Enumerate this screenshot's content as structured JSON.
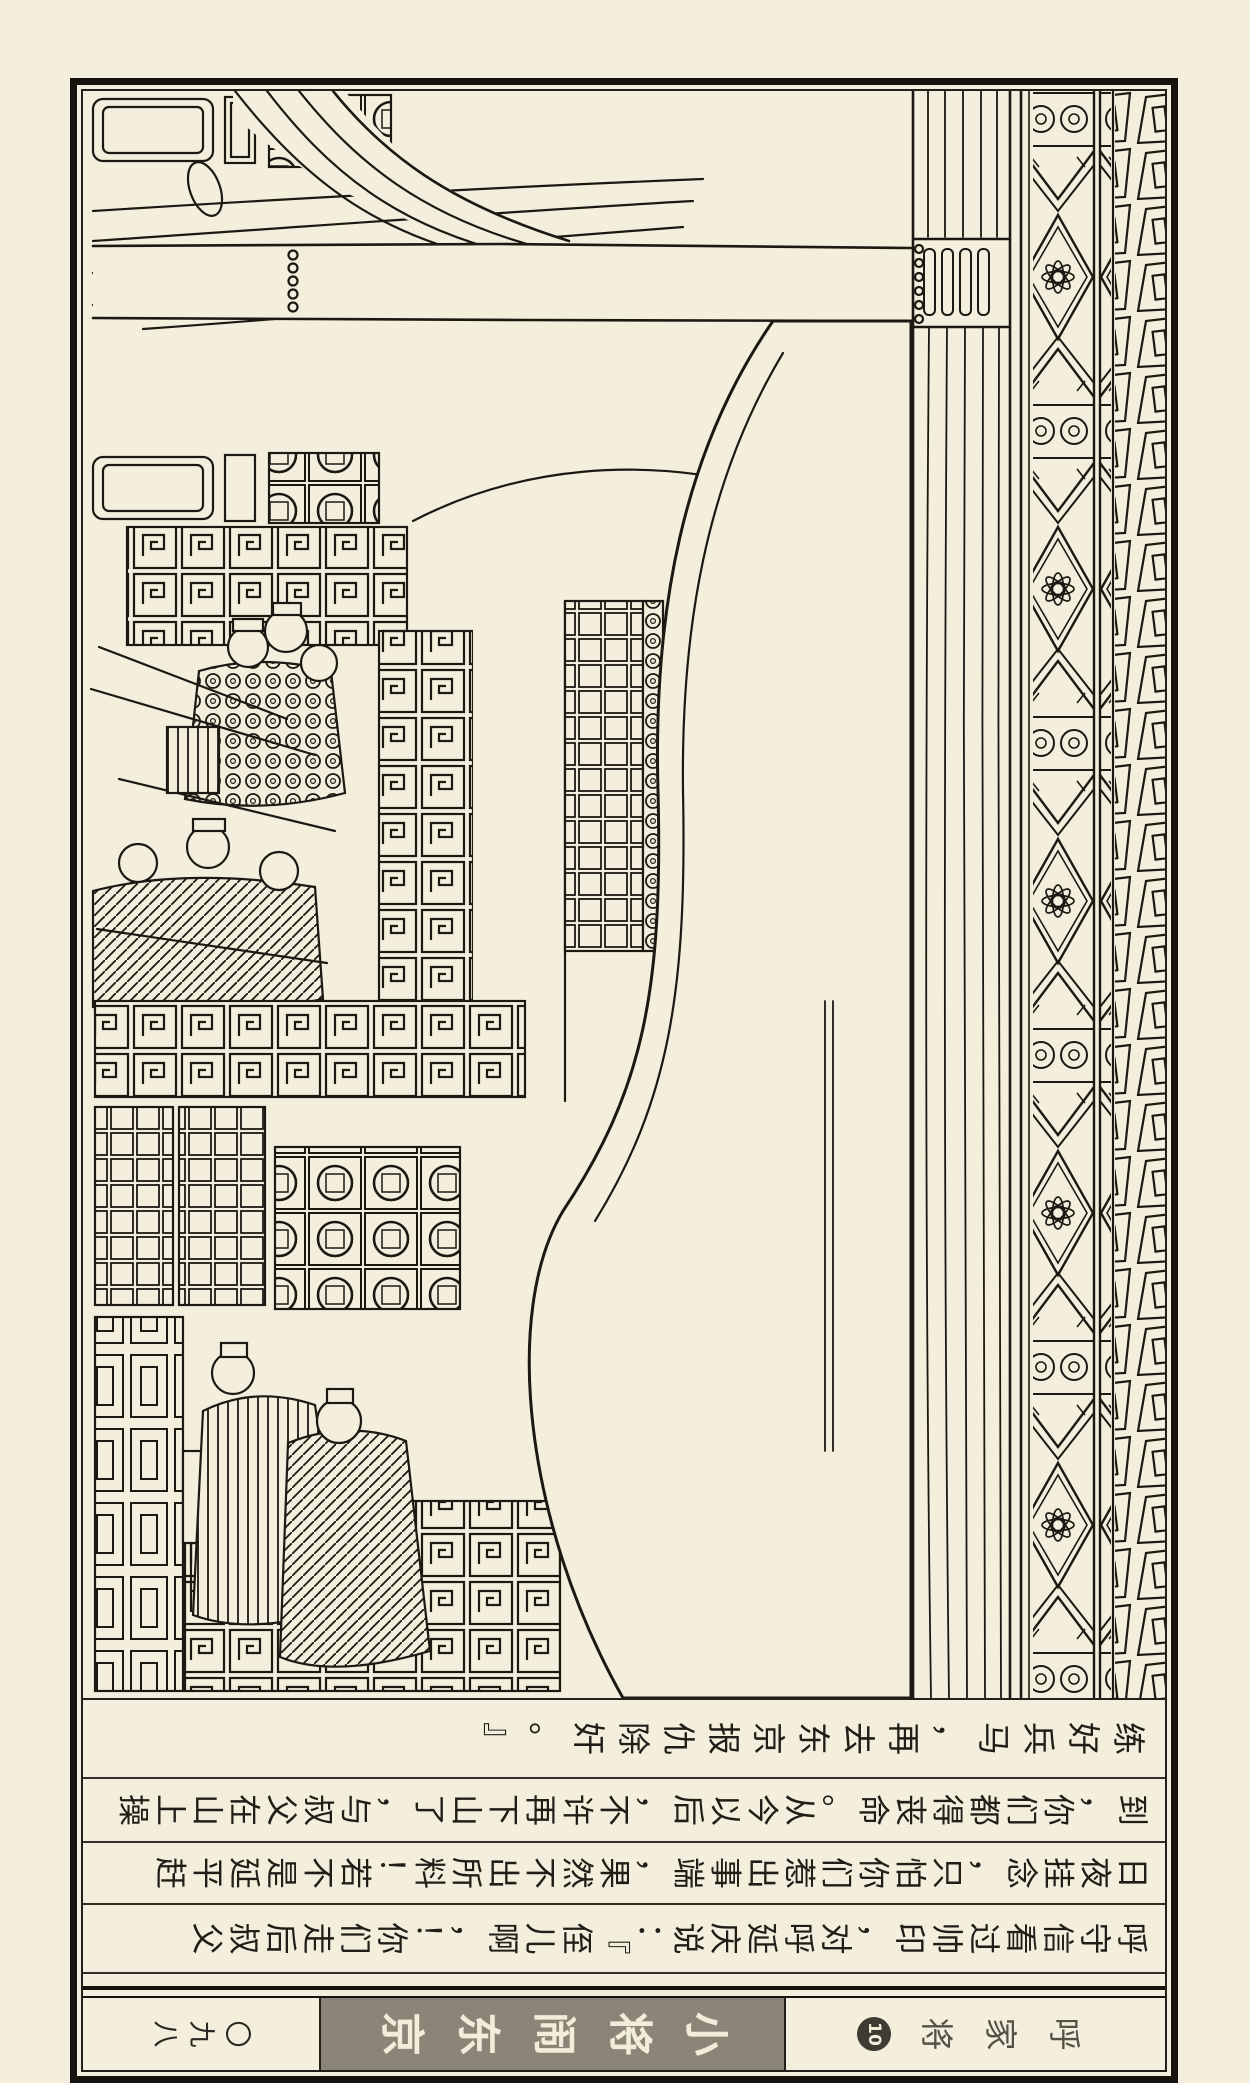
{
  "meta": {
    "description": "Scanned page of the Chinese lianhuanhua comic 呼家将 (vol.10 小将闹东京), shown rotated 90°: an ink line-art palace scene above four rows of rotated caption text and a footer band.",
    "reading_note": "Page is rotated; to read, turn 90° clockwise. Captions read bottom row first, right to left within each row."
  },
  "palette": {
    "paper": "#f3efdc",
    "ink": "#1c1913",
    "footer_block_bg": "#8b8578",
    "footer_block_fg": "#f1edda",
    "series_title_fg": "#565146",
    "page_number_fg": "#2b2822"
  },
  "caption": {
    "rows_top_to_bottom": [
      {
        "text": "练好兵马，再去东京报仇除奸。』"
      },
      {
        "text": "到，你们都得丧命。从今以后，不许再下山了，与叔父在山上操"
      },
      {
        "text": "日夜挂念，只怕你们惹出事端，果然不出所料！若不是延平赶"
      },
      {
        "text": "呼守信看过帅印，对呼延庆说：『侄儿啊，！你们走后叔父"
      }
    ]
  },
  "footer": {
    "page_number": "〇九八",
    "episode_title": "小将闹东京",
    "series_title": "呼家将",
    "issue_number": "10"
  },
  "illustration": {
    "alt": "Ink line drawing of a palace hall: ornate floral and fretwork eave borders and a great pillar at right, a huge blank-robed figure mass at center, armored attendants, latticed windows, coin-grid panels and key-fret brick railings at left."
  }
}
